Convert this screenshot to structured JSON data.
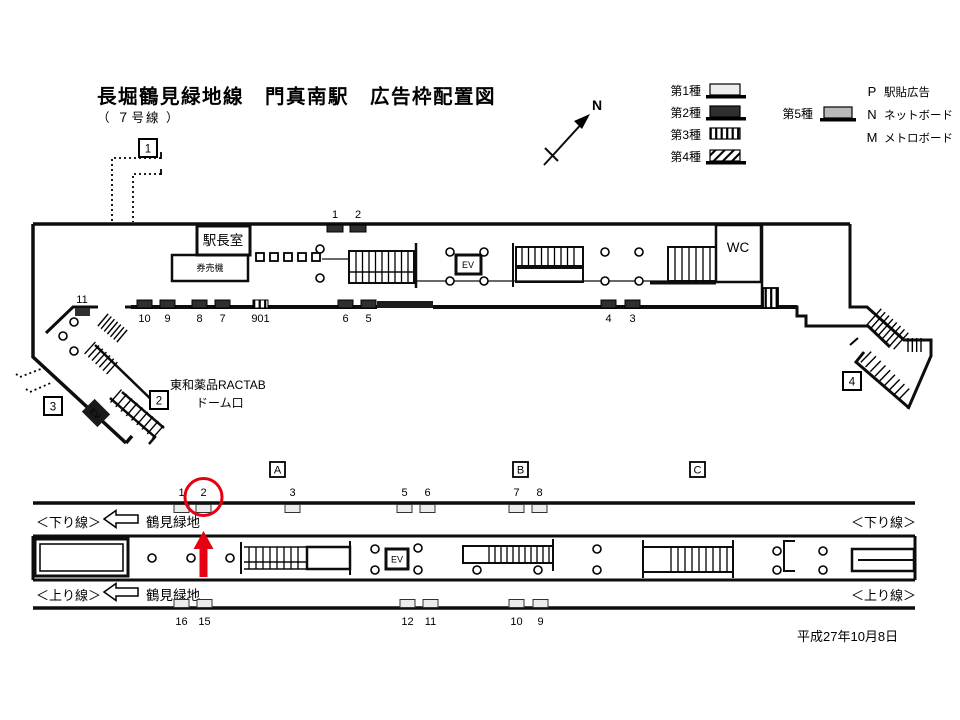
{
  "title": "長堀鶴見緑地線　門真南駅　広告枠配置図",
  "subtitle": "（ ７号線 ）",
  "compass_label": "N",
  "colors": {
    "red": "#e60012",
    "type1_fill": "#ececec",
    "type2_fill": "#2f2f2f",
    "type5_fill": "#b9b9b9",
    "line": "#0d0d0d"
  },
  "legend": {
    "col1": [
      {
        "label": "第1種",
        "style": "type1"
      },
      {
        "label": "第2種",
        "style": "type2"
      },
      {
        "label": "第3種",
        "style": "type3"
      },
      {
        "label": "第4種",
        "style": "type4"
      }
    ],
    "col2": [
      {
        "label": "第5種",
        "style": "type5"
      }
    ],
    "codes": [
      {
        "code": "P",
        "label": "駅貼広告"
      },
      {
        "code": "N",
        "label": "ネットボード"
      },
      {
        "code": "M",
        "label": "メトロボード"
      }
    ]
  },
  "concourse": {
    "rooms": {
      "station_office": "駅長室",
      "ticket_machines": "券売機",
      "wc": "WC"
    },
    "ev_label": "EV",
    "exit_boxes": [
      {
        "label": "1",
        "x": 139,
        "y": 139
      },
      {
        "label": "2",
        "x": 150,
        "y": 391
      },
      {
        "label": "3",
        "x": 44,
        "y": 397
      },
      {
        "label": "4",
        "x": 843,
        "y": 372
      }
    ],
    "exit_note_line1": "東和薬品RACTAB",
    "exit_note_line2": "ドーム口",
    "top_ads": [
      {
        "num": "1",
        "x": 327,
        "type": "type2"
      },
      {
        "num": "2",
        "x": 350,
        "type": "type2"
      }
    ],
    "bottom_ads": [
      {
        "num": "10",
        "x": 137,
        "type": "type2"
      },
      {
        "num": "9",
        "x": 160,
        "type": "type2"
      },
      {
        "num": "8",
        "x": 192,
        "type": "type2"
      },
      {
        "num": "7",
        "x": 215,
        "type": "type2"
      },
      {
        "num": "901",
        "x": 253,
        "type": "type3"
      },
      {
        "num": "6",
        "x": 338,
        "type": "type2"
      },
      {
        "num": "5",
        "x": 361,
        "type": "type2"
      },
      {
        "num": "4",
        "x": 601,
        "type": "type2"
      },
      {
        "num": "3",
        "x": 625,
        "type": "type2"
      }
    ],
    "corner_ad": {
      "num": "11",
      "x": 75
    }
  },
  "platform": {
    "section_markers": [
      {
        "label": "A",
        "x": 270
      },
      {
        "label": "B",
        "x": 513
      },
      {
        "label": "C",
        "x": 690
      }
    ],
    "top_ads": [
      {
        "num": "1",
        "x": 174
      },
      {
        "num": "2",
        "x": 196,
        "highlight": true
      },
      {
        "num": "3",
        "x": 285
      },
      {
        "num": "5",
        "x": 397
      },
      {
        "num": "6",
        "x": 420
      },
      {
        "num": "7",
        "x": 509
      },
      {
        "num": "8",
        "x": 532
      }
    ],
    "bottom_ads": [
      {
        "num": "16",
        "x": 174
      },
      {
        "num": "15",
        "x": 197
      },
      {
        "num": "12",
        "x": 400
      },
      {
        "num": "11",
        "x": 423
      },
      {
        "num": "10",
        "x": 509
      },
      {
        "num": "9",
        "x": 533
      }
    ],
    "down_line_label": "＜下り線＞",
    "up_line_label": "＜上り線＞",
    "direction_label": "鶴見緑地",
    "ev_label": "EV"
  },
  "date": "平成27年10月8日"
}
